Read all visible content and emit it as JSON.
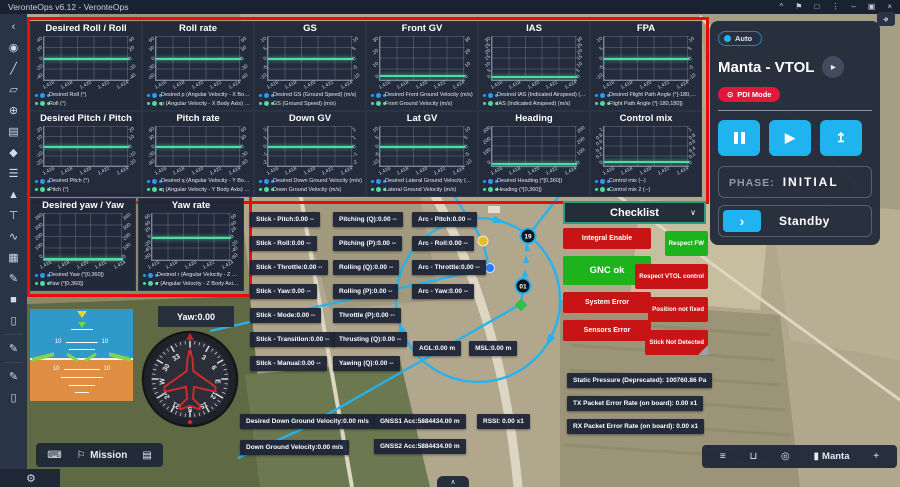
{
  "window": {
    "title": "VeronteOps v6.12 - VeronteOps",
    "controls": [
      {
        "name": "chevron-up-icon",
        "glyph": "^"
      },
      {
        "name": "flag-icon",
        "glyph": "⚑"
      },
      {
        "name": "maximize-icon",
        "glyph": "□"
      },
      {
        "name": "menu-dots-icon",
        "glyph": "⋮"
      },
      {
        "name": "minimize-icon",
        "glyph": "–"
      },
      {
        "name": "restore-icon",
        "glyph": "▣"
      },
      {
        "name": "close-icon",
        "glyph": "×"
      }
    ],
    "expand_glyph": "»"
  },
  "colors": {
    "accent_cyan": "#1fb3f0",
    "series_blue": "#2e9bf0",
    "series_green": "#4fd9a2",
    "status_red": "#c81414",
    "status_green": "#1cb31c",
    "alert_frame": "#e80c0c",
    "pdi_red": "#e3173c",
    "checklist_border": "#2f9d7c"
  },
  "sidebar": {
    "icons": [
      {
        "name": "collapse-icon",
        "glyph": "‹"
      },
      {
        "name": "location-pin-icon",
        "glyph": "◉"
      },
      {
        "name": "measure-line-icon",
        "glyph": "╱"
      },
      {
        "name": "polygon-icon",
        "glyph": "▱"
      },
      {
        "name": "globe-icon",
        "glyph": "⊕"
      },
      {
        "name": "clipboard-icon",
        "glyph": "▤"
      },
      {
        "name": "pentagon-marker-icon",
        "glyph": "◆"
      },
      {
        "name": "routes-icon",
        "glyph": "☰"
      },
      {
        "name": "elevation-icon",
        "glyph": "▲"
      },
      {
        "name": "pin-icon",
        "glyph": "⊤"
      },
      {
        "name": "curve-icon",
        "glyph": "∿"
      },
      {
        "name": "grid-table-icon",
        "glyph": "▦"
      },
      {
        "name": "edit-box-icon",
        "glyph": "✎"
      },
      {
        "name": "filled-square-icon",
        "glyph": "■"
      },
      {
        "name": "trash-icon",
        "glyph": "▯"
      },
      {
        "divider": true
      },
      {
        "name": "draw-icon",
        "glyph": "✎"
      },
      {
        "divider": true
      },
      {
        "name": "annotate-icon",
        "glyph": "✎"
      },
      {
        "name": "delete-icon",
        "glyph": "▯"
      }
    ],
    "gear_glyph": "⚙"
  },
  "charts": {
    "type": "line",
    "x_ticks": [
      "1,416",
      "1,418",
      "1,420",
      "1,422",
      "1,424"
    ],
    "items": [
      {
        "title": "Desired Roll / Roll",
        "y_ticks": [
          "40",
          "20",
          "0",
          "-20",
          "-40"
        ],
        "line_frac": 0.5,
        "legend": [
          "Desired Roll (°)",
          "Roll (°)"
        ],
        "values": [
          0,
          0
        ]
      },
      {
        "title": "Roll rate",
        "y_ticks": [
          "60",
          "30",
          "0",
          "-30",
          "-60"
        ],
        "line_frac": 0.5,
        "legend": [
          "Desired p (Angular Velocity - X Body Axis) (°/s)",
          "p (Angular Velocity - X Body Axis) (°/s)"
        ],
        "values": [
          0,
          0
        ]
      },
      {
        "title": "GS",
        "y_ticks": [
          "10",
          "5",
          "0",
          "-5",
          "-10"
        ],
        "line_frac": 0.5,
        "legend": [
          "Desired GS (Ground Speed) (m/s)",
          "GS (Ground Speed) (m/s)"
        ],
        "values": [
          0,
          0
        ]
      },
      {
        "title": "Front GV",
        "y_ticks": [
          "30",
          "20",
          "10",
          "0"
        ],
        "line_frac": 0.88,
        "legend": [
          "Desired Front Ground Velocity (m/s)",
          "Front Ground Velocity (m/s)"
        ],
        "values": [
          0,
          0
        ]
      },
      {
        "title": "IAS",
        "y_ticks": [
          "30",
          "25",
          "20",
          "15",
          "10",
          "5",
          "0"
        ],
        "line_frac": 0.9,
        "legend": [
          "Desired IAS (Indicated Airspeed) (m/s)",
          "IAS (Indicated Airspeed) (m/s)"
        ],
        "values": [
          0,
          0
        ]
      },
      {
        "title": "FPA",
        "y_ticks": [
          "10",
          "5",
          "0",
          "-5",
          "-10"
        ],
        "line_frac": 0.5,
        "legend": [
          "Desired Flight Path Angle (°[-180,180])",
          "Flight Path Angle (°[-180,180])"
        ],
        "values": [
          0,
          0
        ]
      },
      {
        "title": "Desired Pitch / Pitch",
        "y_ticks": [
          "20",
          "10",
          "0",
          "-10",
          "-20"
        ],
        "line_frac": 0.5,
        "legend": [
          "Desired Pitch (°)",
          "Pitch (°)"
        ],
        "values": [
          0,
          0
        ]
      },
      {
        "title": "Pitch rate",
        "y_ticks": [
          "60",
          "30",
          "0",
          "-30",
          "-60"
        ],
        "line_frac": 0.5,
        "legend": [
          "Desired q (Angular Velocity - Y Body Axis) (°/s)",
          "q (Angular Velocity - Y Body Axis) (°/s)"
        ],
        "values": [
          0,
          0
        ]
      },
      {
        "title": "Down GV",
        "y_ticks": [
          "2",
          "1",
          "0",
          "-1",
          "-2"
        ],
        "line_frac": 0.5,
        "legend": [
          "Desired Down Ground Velocity (m/s)",
          "Down Ground Velocity (m/s)"
        ],
        "values": [
          0,
          0
        ]
      },
      {
        "title": "Lat GV",
        "y_ticks": [
          "10",
          "5",
          "0",
          "-5",
          "-10"
        ],
        "line_frac": 0.5,
        "legend": [
          "Desired Lateral Ground Velocity (m/s)",
          "Lateral Ground Velocity (m/s)"
        ],
        "values": [
          0,
          0
        ]
      },
      {
        "title": "Heading",
        "y_ticks": [
          "300",
          "200",
          "100",
          "0"
        ],
        "line_frac": 0.93,
        "legend": [
          "Desired Heading (°[0,360])",
          "Heading (°[0,360])"
        ],
        "values": [
          0,
          0
        ]
      },
      {
        "title": "Control mix",
        "y_ticks": [
          "1",
          "0.8",
          "0.6",
          "0.4",
          "0.2",
          "0"
        ],
        "line_frac": 0.88,
        "legend": [
          "Control mix (--)",
          "Control mix 2 (--)"
        ],
        "values": [
          0,
          0
        ]
      },
      {
        "title": "Desired yaw / Yaw",
        "y_ticks": [
          "360",
          "300",
          "200",
          "100",
          "0"
        ],
        "line_frac": 0.95,
        "legend": [
          "Desired Yaw (°[0,360])",
          "Yaw (°[0,360])"
        ],
        "values": [
          0,
          0
        ]
      },
      {
        "title": "Yaw rate",
        "y_ticks": [
          "60",
          "40",
          "20",
          "0",
          "-20",
          "-40",
          "-60"
        ],
        "line_frac": 0.5,
        "legend": [
          "Desired r (Angular Velocity - Z Body Axis) (°/s)",
          "r (Angular Velocity - Z Body Axis) (°/s)"
        ],
        "values": [
          0,
          0
        ]
      }
    ]
  },
  "telemetry": {
    "stick": [
      "Stick - Pitch:0.00 --",
      "Stick - Roll:0.00 --",
      "Stick - Throttle:0.00 --",
      "Stick - Yaw:0.00 --",
      "Stick - Mode:0.00 --",
      "Stick - Transition:0.00 --",
      "Stick - Manual:0.00 --"
    ],
    "mixing": [
      "Pitching (Q):0.00 --",
      "Pitching (P):0.00 --",
      "Rolling (Q):0.00 --",
      "Rolling (P):0.00 --",
      "Throttle (P):0.00 --",
      "Thrusting (Q):0.00 --",
      "Yawing (Q):0.00 --"
    ],
    "arc": [
      "Arc - Pitch:0.00 --",
      "Arc - Roll:0.00 --",
      "Arc - Throttle:0.00 --",
      "Arc - Yaw:0.00 --"
    ],
    "altitude": [
      "AGL:0.00 m",
      "MSL:0.00 m"
    ],
    "down_velocity": [
      "Desired Down Ground Velocity:0.00 m/s",
      "Down Ground Velocity:0.00 m/s"
    ],
    "gnss": [
      "GNSS1 Acc:5884434.00 m",
      "GNSS2 Acc:5884434.00 m"
    ],
    "rssi": [
      "RSSI: 0.00 x1"
    ],
    "link": [
      "Static Pressure (Deprecated): 100760.86 Pa",
      "TX Packet Error Rate (on board): 0.00 x1",
      "RX Packet Error Rate (on board): 0.00 x1"
    ]
  },
  "status": {
    "left": [
      {
        "label": "Integral Enable",
        "tone": "red"
      },
      {
        "label": "GNC ok",
        "tone": "green",
        "big": true
      },
      {
        "label": "System Error",
        "tone": "red"
      },
      {
        "label": "Sensors Error",
        "tone": "red"
      }
    ],
    "right": [
      {
        "label": "Respect FW",
        "tone": "green"
      },
      {
        "label": "Respect VTOL control",
        "tone": "red"
      },
      {
        "label": "Position not fixed",
        "tone": "red"
      },
      {
        "label": "Stick Not Detected",
        "tone": "red",
        "fold": true
      }
    ]
  },
  "checklist": {
    "label": "Checklist",
    "chevron": "∨"
  },
  "right_panel": {
    "auto_label": "Auto",
    "title": "Manta - VTOL",
    "vehicle_icon": "▸",
    "mode_icon": "⊙",
    "mode_label": "PDI Mode",
    "play_glyph": "▶",
    "upload_glyph": "↥",
    "phase_label": "PHASE:",
    "phase_value": "INITIAL",
    "action_label": "Standby",
    "action_chevron": "›"
  },
  "compass": {
    "yaw_label": "Yaw:0.00",
    "labels": [
      "N",
      "3",
      "6",
      "E",
      "12",
      "15",
      "S",
      "21",
      "24",
      "W",
      "30",
      "33"
    ]
  },
  "attitude": {
    "tick_label": "10"
  },
  "map": {
    "waypoints": [
      "19",
      "01"
    ]
  },
  "bottom_left_bar": {
    "label": "Mission",
    "icons": [
      {
        "name": "keyboard-icon",
        "glyph": "⌨"
      },
      {
        "name": "route-flag-icon",
        "glyph": "⚐"
      },
      {
        "name": "map-save-icon",
        "glyph": "▤"
      }
    ]
  },
  "bottom_right_bar": {
    "label": "Manta",
    "icons": [
      {
        "name": "filter-icon",
        "glyph": "≡"
      },
      {
        "name": "unlock-icon",
        "glyph": "⊔"
      },
      {
        "name": "visibility-icon",
        "glyph": "◎"
      },
      {
        "name": "battery-icon",
        "glyph": "▮"
      },
      {
        "name": "add-icon",
        "glyph": "+"
      }
    ]
  },
  "misc": {
    "expand_tab": "∧"
  }
}
